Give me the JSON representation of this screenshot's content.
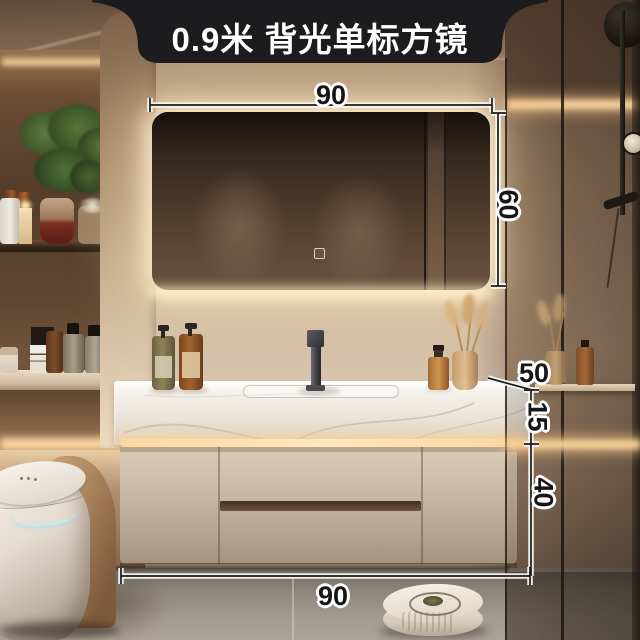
{
  "banner": {
    "title": "0.9米 背光单标方镜"
  },
  "dimensions": {
    "mirror_width": "90",
    "mirror_height": "60",
    "counter_depth": "50",
    "counter_height": "15",
    "cabinet_height": "40",
    "vanity_width": "90"
  },
  "palette": {
    "banner_bg": "#1c1c1f",
    "banner_text": "#ffffff",
    "dimension_text": "#161616",
    "dimension_halo": "#ffffff",
    "led_glow": "#ffdfae",
    "wall": "#c9b59c",
    "countertop": "#f3efe8",
    "cabinet": "#c6b7a2",
    "mirror_glass": "#4a392c",
    "floor": "#9a948a",
    "toilet_led": "#bfe8f2"
  }
}
